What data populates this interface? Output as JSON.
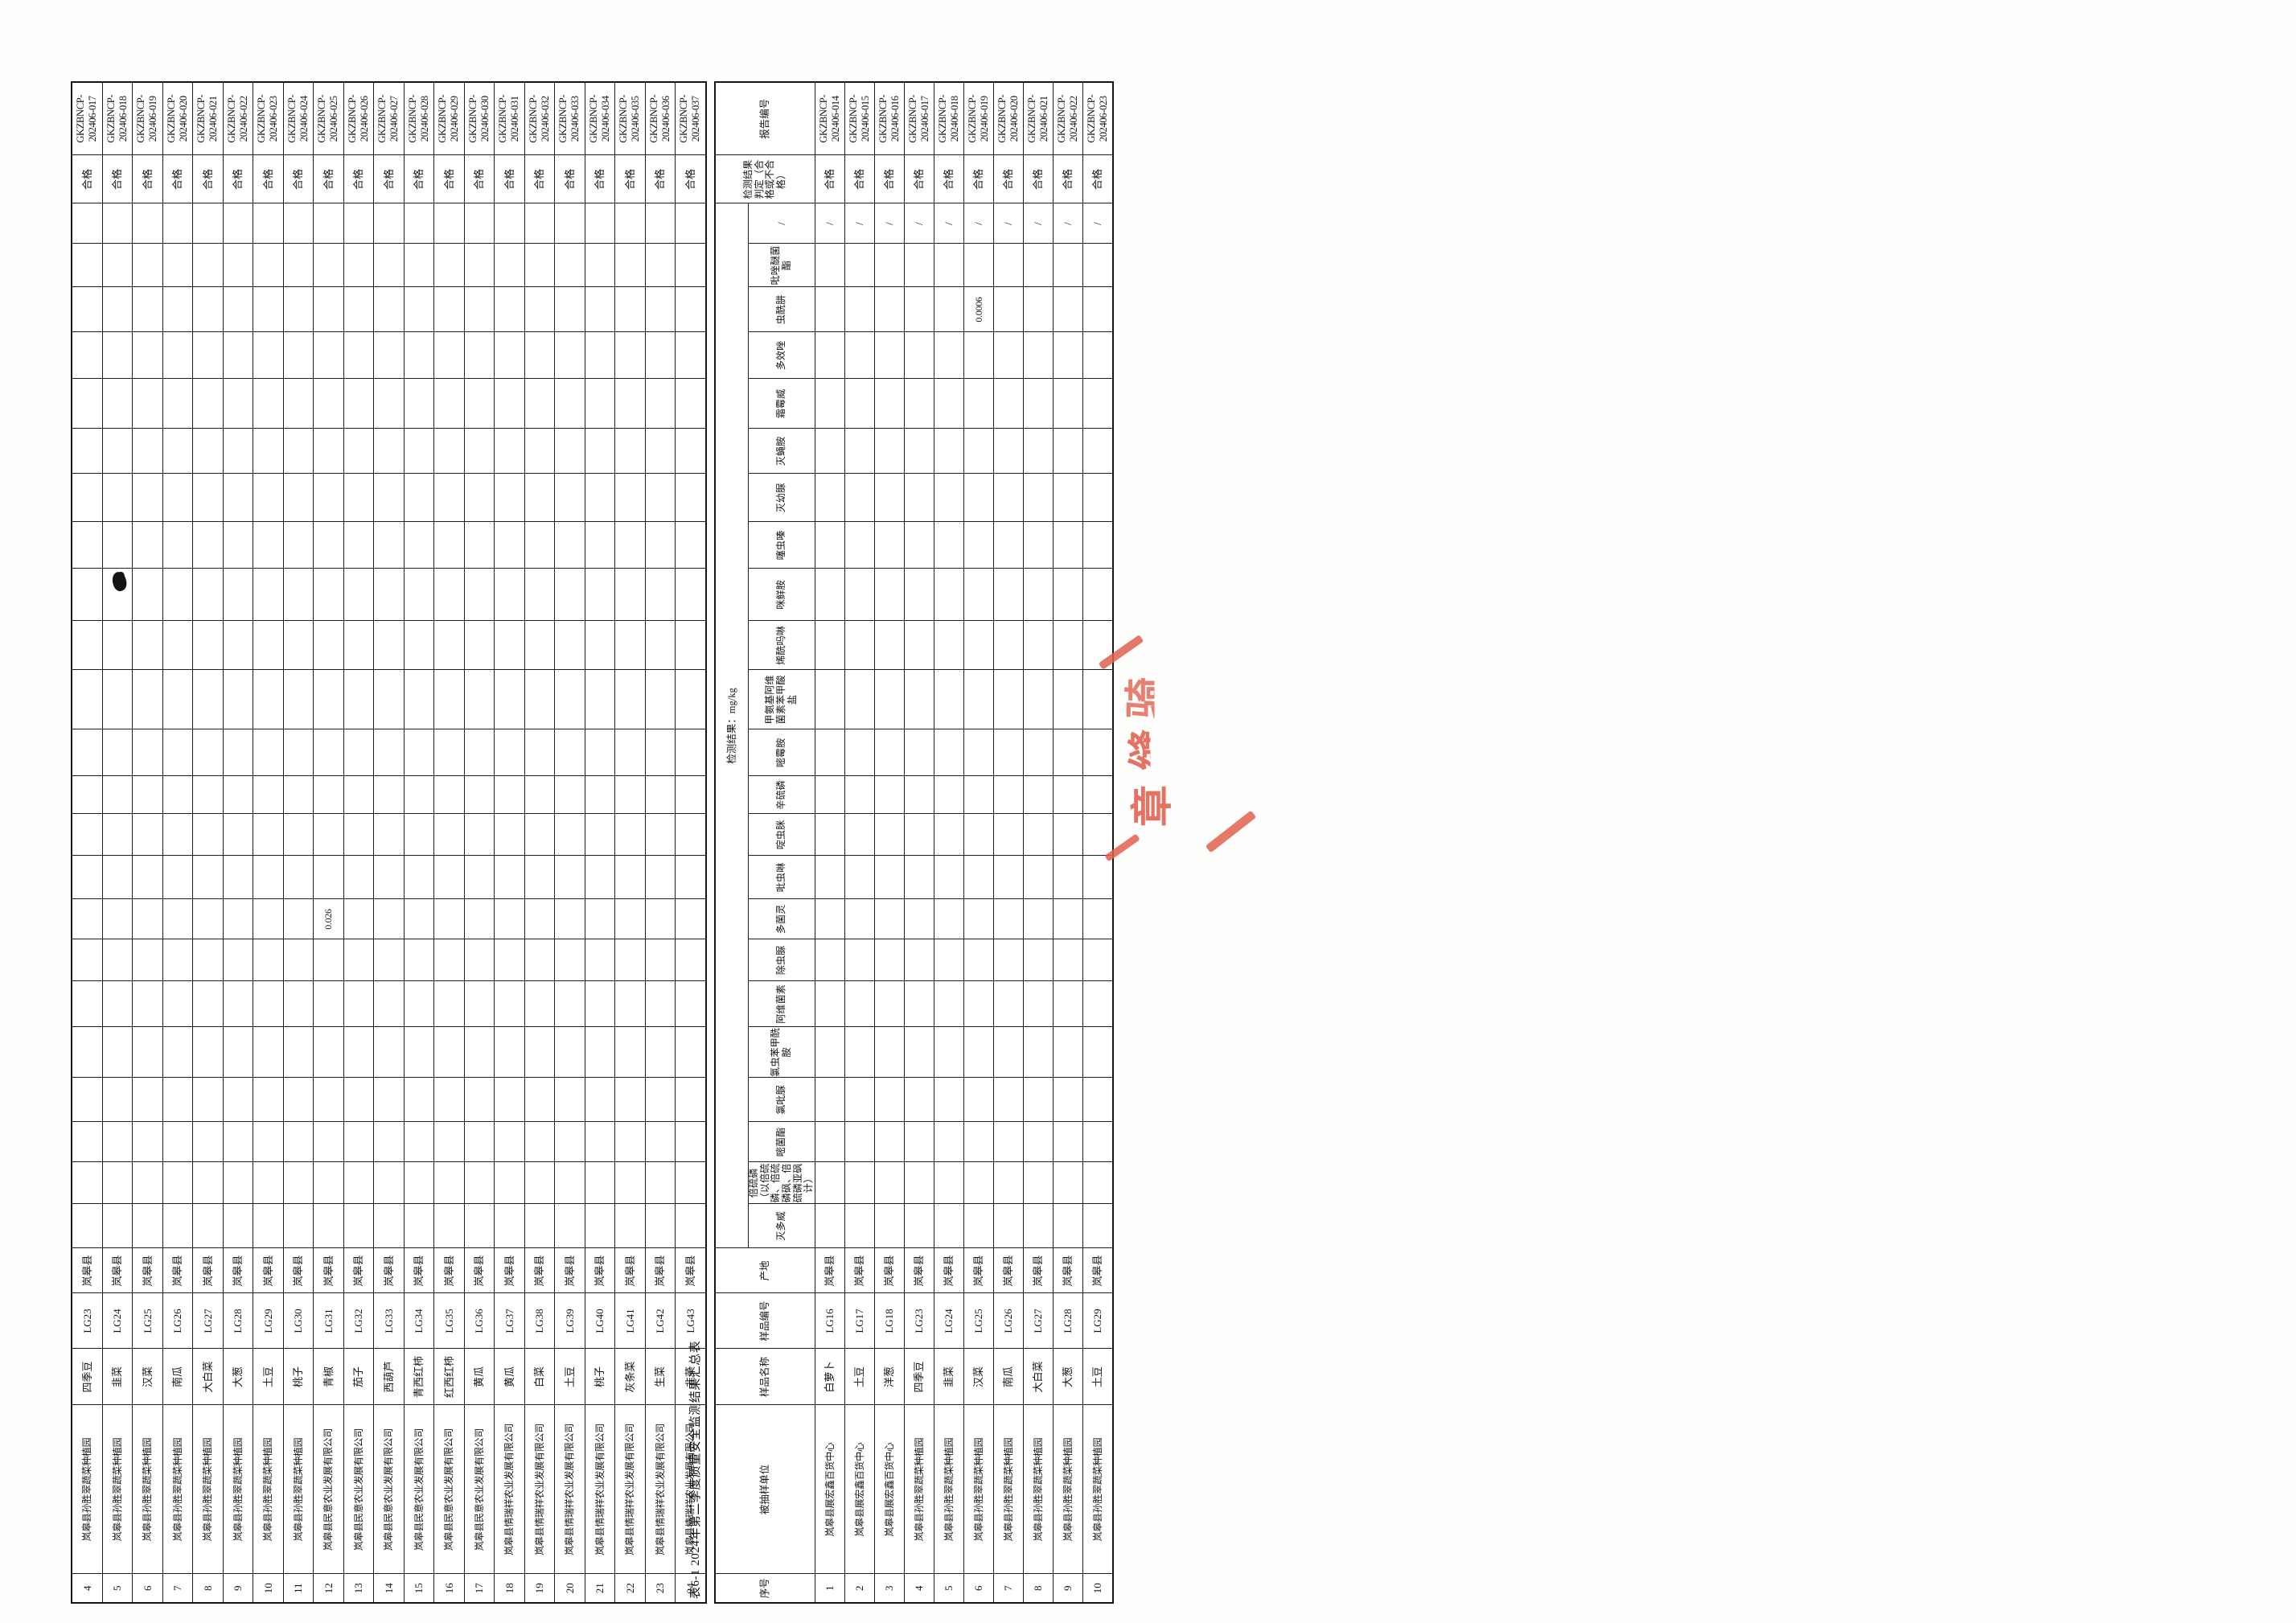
{
  "document": {
    "table_title": "表6-1 2024年第二季度质量安全监测结果汇总表",
    "stamp_visible_chars": "章缝骑",
    "stamp_color": "#e2604f"
  },
  "columns": {
    "serial": "序号",
    "entity": "被抽样单位",
    "sample_name": "样品名称",
    "sample_code": "样品编号",
    "origin": "产地",
    "results_group": "检测结果：mg/kg",
    "slash": "/",
    "verdict": "检测结果判定（合格或不合格）",
    "report_no": "报告编号"
  },
  "pesticides": [
    "灭多威",
    "倍硫磷（以倍硫磷、倍硫磷砜、倍硫磷亚砜计）",
    "嘧菌酯",
    "氯吡脲",
    "氯虫苯甲酰胺",
    "阿维菌素",
    "除虫脲",
    "多菌灵",
    "吡虫啉",
    "啶虫脒",
    "辛硫磷",
    "嘧霉胺",
    "甲氨基阿维菌素苯甲酸盐",
    "烯酰吗啉",
    "咪鲜胺",
    "噻虫嗪",
    "灭幼脲",
    "灭蝇胺",
    "霜霉威",
    "多效唑",
    "虫酰肼",
    "吡唑醚菌酯"
  ],
  "continuation_table": {
    "rows": [
      {
        "serial": "4",
        "entity": "岚皋县孙胜翠蔬菜种植园",
        "sample": "四季豆",
        "code": "LG23",
        "origin": "岚皋县",
        "results": {},
        "verdict": "合格",
        "report": "GKZBNCP-202406-017"
      },
      {
        "serial": "5",
        "entity": "岚皋县孙胜翠蔬菜种植园",
        "sample": "韭菜",
        "code": "LG24",
        "origin": "岚皋县",
        "results": {},
        "verdict": "合格",
        "report": "GKZBNCP-202406-018"
      },
      {
        "serial": "6",
        "entity": "岚皋县孙胜翠蔬菜种植园",
        "sample": "汉菜",
        "code": "LG25",
        "origin": "岚皋县",
        "results": {},
        "verdict": "合格",
        "report": "GKZBNCP-202406-019"
      },
      {
        "serial": "7",
        "entity": "岚皋县孙胜翠蔬菜种植园",
        "sample": "南瓜",
        "code": "LG26",
        "origin": "岚皋县",
        "results": {},
        "verdict": "合格",
        "report": "GKZBNCP-202406-020"
      },
      {
        "serial": "8",
        "entity": "岚皋县孙胜翠蔬菜种植园",
        "sample": "大白菜",
        "code": "LG27",
        "origin": "岚皋县",
        "results": {},
        "verdict": "合格",
        "report": "GKZBNCP-202406-021"
      },
      {
        "serial": "9",
        "entity": "岚皋县孙胜翠蔬菜种植园",
        "sample": "大葱",
        "code": "LG28",
        "origin": "岚皋县",
        "results": {},
        "verdict": "合格",
        "report": "GKZBNCP-202406-022"
      },
      {
        "serial": "10",
        "entity": "岚皋县孙胜翠蔬菜种植园",
        "sample": "土豆",
        "code": "LG29",
        "origin": "岚皋县",
        "results": {},
        "verdict": "合格",
        "report": "GKZBNCP-202406-023"
      },
      {
        "serial": "11",
        "entity": "岚皋县孙胜翠蔬菜种植园",
        "sample": "桃子",
        "code": "LG30",
        "origin": "岚皋县",
        "results": {},
        "verdict": "合格",
        "report": "GKZBNCP-202406-024"
      },
      {
        "serial": "12",
        "entity": "岚皋县民意农业发展有限公司",
        "sample": "青椒",
        "code": "LG31",
        "origin": "岚皋县",
        "results": {
          "多菌灵": "0.026"
        },
        "verdict": "合格",
        "report": "GKZBNCP-202406-025"
      },
      {
        "serial": "13",
        "entity": "岚皋县民意农业发展有限公司",
        "sample": "茄子",
        "code": "LG32",
        "origin": "岚皋县",
        "results": {},
        "verdict": "合格",
        "report": "GKZBNCP-202406-026"
      },
      {
        "serial": "14",
        "entity": "岚皋县民意农业发展有限公司",
        "sample": "西葫芦",
        "code": "LG33",
        "origin": "岚皋县",
        "results": {},
        "verdict": "合格",
        "report": "GKZBNCP-202406-027"
      },
      {
        "serial": "15",
        "entity": "岚皋县民意农业发展有限公司",
        "sample": "青西红柿",
        "code": "LG34",
        "origin": "岚皋县",
        "results": {},
        "verdict": "合格",
        "report": "GKZBNCP-202406-028"
      },
      {
        "serial": "16",
        "entity": "岚皋县民意农业发展有限公司",
        "sample": "红西红柿",
        "code": "LG35",
        "origin": "岚皋县",
        "results": {},
        "verdict": "合格",
        "report": "GKZBNCP-202406-029"
      },
      {
        "serial": "17",
        "entity": "岚皋县民意农业发展有限公司",
        "sample": "黄瓜",
        "code": "LG36",
        "origin": "岚皋县",
        "results": {},
        "verdict": "合格",
        "report": "GKZBNCP-202406-030"
      },
      {
        "serial": "18",
        "entity": "岚皋县情瑞祥农业发展有限公司",
        "sample": "黄瓜",
        "code": "LG37",
        "origin": "岚皋县",
        "results": {},
        "verdict": "合格",
        "report": "GKZBNCP-202406-031"
      },
      {
        "serial": "19",
        "entity": "岚皋县情瑞祥农业发展有限公司",
        "sample": "白菜",
        "code": "LG38",
        "origin": "岚皋县",
        "results": {},
        "verdict": "合格",
        "report": "GKZBNCP-202406-032"
      },
      {
        "serial": "20",
        "entity": "岚皋县情瑞祥农业发展有限公司",
        "sample": "土豆",
        "code": "LG39",
        "origin": "岚皋县",
        "results": {},
        "verdict": "合格",
        "report": "GKZBNCP-202406-033"
      },
      {
        "serial": "21",
        "entity": "岚皋县情瑞祥农业发展有限公司",
        "sample": "桃子",
        "code": "LG40",
        "origin": "岚皋县",
        "results": {},
        "verdict": "合格",
        "report": "GKZBNCP-202406-034"
      },
      {
        "serial": "22",
        "entity": "岚皋县情瑞祥农业发展有限公司",
        "sample": "灰条菜",
        "code": "LG41",
        "origin": "岚皋县",
        "results": {},
        "verdict": "合格",
        "report": "GKZBNCP-202406-035"
      },
      {
        "serial": "23",
        "entity": "岚皋县情瑞祥农业发展有限公司",
        "sample": "生菜",
        "code": "LG42",
        "origin": "岚皋县",
        "results": {},
        "verdict": "合格",
        "report": "GKZBNCP-202406-036"
      },
      {
        "serial": "24",
        "entity": "岚皋县情瑞祥农业发展有限公司",
        "sample": "韭菜",
        "code": "LG43",
        "origin": "岚皋县",
        "results": {},
        "verdict": "合格",
        "report": "GKZBNCP-202406-037"
      }
    ]
  },
  "main_table": {
    "rows": [
      {
        "serial": "1",
        "entity": "岚皋县展宏鑫百货中心",
        "sample": "白萝卜",
        "code": "LG16",
        "origin": "岚皋县",
        "results": {},
        "slash": "/",
        "verdict": "合格",
        "report": "GKZBNCP-202406-014"
      },
      {
        "serial": "2",
        "entity": "岚皋县展宏鑫百货中心",
        "sample": "土豆",
        "code": "LG17",
        "origin": "岚皋县",
        "results": {},
        "slash": "/",
        "verdict": "合格",
        "report": "GKZBNCP-202406-015"
      },
      {
        "serial": "3",
        "entity": "岚皋县展宏鑫百货中心",
        "sample": "洋葱",
        "code": "LG18",
        "origin": "岚皋县",
        "results": {},
        "slash": "/",
        "verdict": "合格",
        "report": "GKZBNCP-202406-016"
      },
      {
        "serial": "4",
        "entity": "岚皋县孙胜翠蔬菜种植园",
        "sample": "四季豆",
        "code": "LG23",
        "origin": "岚皋县",
        "results": {},
        "slash": "/",
        "verdict": "合格",
        "report": "GKZBNCP-202406-017"
      },
      {
        "serial": "5",
        "entity": "岚皋县孙胜翠蔬菜种植园",
        "sample": "韭菜",
        "code": "LG24",
        "origin": "岚皋县",
        "results": {},
        "slash": "/",
        "verdict": "合格",
        "report": "GKZBNCP-202406-018"
      },
      {
        "serial": "6",
        "entity": "岚皋县孙胜翠蔬菜种植园",
        "sample": "汉菜",
        "code": "LG25",
        "origin": "岚皋县",
        "results": {
          "虫酰肼": "0.0006"
        },
        "slash": "/",
        "verdict": "合格",
        "report": "GKZBNCP-202406-019"
      },
      {
        "serial": "7",
        "entity": "岚皋县孙胜翠蔬菜种植园",
        "sample": "南瓜",
        "code": "LG26",
        "origin": "岚皋县",
        "results": {},
        "slash": "/",
        "verdict": "合格",
        "report": "GKZBNCP-202406-020"
      },
      {
        "serial": "8",
        "entity": "岚皋县孙胜翠蔬菜种植园",
        "sample": "大白菜",
        "code": "LG27",
        "origin": "岚皋县",
        "results": {},
        "slash": "/",
        "verdict": "合格",
        "report": "GKZBNCP-202406-021"
      },
      {
        "serial": "9",
        "entity": "岚皋县孙胜翠蔬菜种植园",
        "sample": "大葱",
        "code": "LG28",
        "origin": "岚皋县",
        "results": {},
        "slash": "/",
        "verdict": "合格",
        "report": "GKZBNCP-202406-022"
      },
      {
        "serial": "10",
        "entity": "岚皋县孙胜翠蔬菜种植园",
        "sample": "土豆",
        "code": "LG29",
        "origin": "岚皋县",
        "results": {},
        "slash": "/",
        "verdict": "合格",
        "report": "GKZBNCP-202406-023"
      }
    ]
  }
}
